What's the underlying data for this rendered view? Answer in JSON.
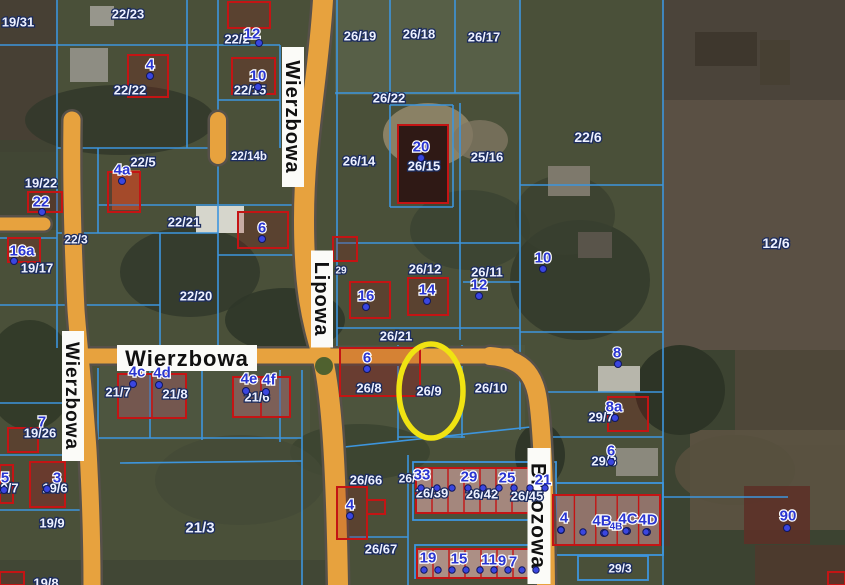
{
  "map": {
    "tool": "cadastral-map-view",
    "highlight": {
      "parcel": "26/9",
      "shape": "ellipse",
      "color": "#F0E312",
      "cx": 431,
      "cy": 391,
      "rx": 32,
      "ry": 47
    },
    "colors": {
      "parcel_line": "#3D95DD",
      "building_outline": "#C41414",
      "street_fill": "#E7A23E",
      "street_casing": "#57514A",
      "parcel_text": "#EDF1FF",
      "building_text": "#2A35D0",
      "highlight": "#F0E312"
    },
    "streets": [
      {
        "name": "Wierzbowa",
        "orientation": "vertical",
        "cx": 293,
        "cy": 117,
        "len": 140,
        "w": 22,
        "fs": 20
      },
      {
        "name": "Lipowa",
        "orientation": "vertical",
        "cx": 322,
        "cy": 299,
        "len": 97,
        "w": 22,
        "fs": 20
      },
      {
        "name": "Wierzbowa",
        "orientation": "horizontal",
        "cx": 187,
        "cy": 358,
        "len": 140,
        "w": 26,
        "fs": 22
      },
      {
        "name": "Wierzbowa",
        "orientation": "vertical",
        "cx": 73,
        "cy": 396,
        "len": 130,
        "w": 22,
        "fs": 19
      },
      {
        "name": "Brzozowa",
        "orientation": "vertical",
        "cx": 539,
        "cy": 516,
        "len": 136,
        "w": 23,
        "fs": 21
      }
    ],
    "parcels": [
      {
        "label": "19/31",
        "x": 18,
        "y": 22
      },
      {
        "label": "22/23",
        "x": 128,
        "y": 14
      },
      {
        "label": "22/2",
        "x": 237,
        "y": 39
      },
      {
        "label": "22/15",
        "x": 250,
        "y": 90
      },
      {
        "label": "22/22",
        "x": 130,
        "y": 90
      },
      {
        "label": "26/19",
        "x": 360,
        "y": 36
      },
      {
        "label": "26/18",
        "x": 419,
        "y": 34
      },
      {
        "label": "26/17",
        "x": 484,
        "y": 37
      },
      {
        "label": "26/22",
        "x": 389,
        "y": 98
      },
      {
        "label": "22/6",
        "x": 588,
        "y": 137,
        "fs": 14
      },
      {
        "label": "12/6",
        "x": 776,
        "y": 243,
        "fs": 14
      },
      {
        "label": "19/22",
        "x": 41,
        "y": 183
      },
      {
        "label": "22/5",
        "x": 143,
        "y": 162
      },
      {
        "label": "22/21",
        "x": 184,
        "y": 222
      },
      {
        "label": "22/20",
        "x": 196,
        "y": 296
      },
      {
        "label": "22/14b",
        "x": 249,
        "y": 156,
        "fs": 11.5
      },
      {
        "label": "19/17",
        "x": 37,
        "y": 268
      },
      {
        "label": "22/3",
        "x": 76,
        "y": 239,
        "fs": 12
      },
      {
        "label": "26/14",
        "x": 359,
        "y": 161
      },
      {
        "label": "26/15",
        "x": 424,
        "y": 166
      },
      {
        "label": "25/16",
        "x": 487,
        "y": 157
      },
      {
        "label": "26/12",
        "x": 425,
        "y": 269
      },
      {
        "label": "26/11",
        "x": 487,
        "y": 272
      },
      {
        "label": "26/21",
        "x": 396,
        "y": 336
      },
      {
        "label": "29",
        "x": 341,
        "y": 270,
        "fs": 10
      },
      {
        "label": "26/8",
        "x": 369,
        "y": 388
      },
      {
        "label": "26/9",
        "x": 429,
        "y": 391
      },
      {
        "label": "26/10",
        "x": 491,
        "y": 388
      },
      {
        "label": "21/7",
        "x": 118,
        "y": 392
      },
      {
        "label": "21/8",
        "x": 175,
        "y": 394
      },
      {
        "label": "21/6",
        "x": 257,
        "y": 397
      },
      {
        "label": "19/26",
        "x": 40,
        "y": 433
      },
      {
        "label": "19/7",
        "x": 6,
        "y": 488
      },
      {
        "label": "19/6",
        "x": 55,
        "y": 488
      },
      {
        "label": "19/9",
        "x": 52,
        "y": 523
      },
      {
        "label": "19/8",
        "x": 46,
        "y": 583
      },
      {
        "label": "21/3",
        "x": 200,
        "y": 527,
        "fs": 15
      },
      {
        "label": "26/66",
        "x": 366,
        "y": 480
      },
      {
        "label": "26/",
        "x": 407,
        "y": 478,
        "fs": 12
      },
      {
        "label": "26/39",
        "x": 432,
        "y": 493
      },
      {
        "label": "26/42",
        "x": 482,
        "y": 494
      },
      {
        "label": "26/45",
        "x": 527,
        "y": 496
      },
      {
        "label": "26/67",
        "x": 381,
        "y": 549
      },
      {
        "label": "29/7",
        "x": 601,
        "y": 417
      },
      {
        "label": "29/3",
        "x": 604,
        "y": 461
      },
      {
        "label": "29/3",
        "x": 620,
        "y": 568,
        "fs": 12
      }
    ],
    "buildings": [
      {
        "label": "4",
        "x": 150,
        "y": 64,
        "dot": [
          150,
          76
        ]
      },
      {
        "label": "12",
        "x": 252,
        "y": 33,
        "dot": [
          259,
          43
        ]
      },
      {
        "label": "10",
        "x": 258,
        "y": 75,
        "dot": [
          258,
          87
        ]
      },
      {
        "label": "22",
        "x": 41,
        "y": 201,
        "dot": [
          42,
          212
        ]
      },
      {
        "label": "16a",
        "x": 22,
        "y": 250,
        "dot": [
          14,
          261
        ]
      },
      {
        "label": "4a",
        "x": 122,
        "y": 169,
        "dot": [
          122,
          181
        ]
      },
      {
        "label": "6",
        "x": 262,
        "y": 227,
        "dot": [
          262,
          239
        ]
      },
      {
        "label": "16",
        "x": 366,
        "y": 295,
        "dot": [
          366,
          307
        ]
      },
      {
        "label": "14",
        "x": 427,
        "y": 289,
        "dot": [
          427,
          301
        ]
      },
      {
        "label": "20",
        "x": 421,
        "y": 146,
        "dot": [
          421,
          158
        ]
      },
      {
        "label": "10",
        "x": 543,
        "y": 257,
        "dot": [
          543,
          269
        ]
      },
      {
        "label": "12",
        "x": 479,
        "y": 284,
        "dot": [
          479,
          296
        ]
      },
      {
        "label": "8",
        "x": 617,
        "y": 352,
        "dot": [
          618,
          364
        ]
      },
      {
        "label": "6",
        "x": 367,
        "y": 357,
        "dot": [
          367,
          369
        ]
      },
      {
        "label": "4c",
        "x": 137,
        "y": 371,
        "dot": [
          133,
          384
        ]
      },
      {
        "label": "4d",
        "x": 162,
        "y": 372,
        "dot": [
          159,
          385
        ]
      },
      {
        "label": "4e",
        "x": 249,
        "y": 378,
        "dot": [
          246,
          391
        ]
      },
      {
        "label": "4f",
        "x": 269,
        "y": 379,
        "dot": [
          266,
          392
        ]
      },
      {
        "label": "7",
        "x": 42,
        "y": 421
      },
      {
        "label": "3",
        "x": 57,
        "y": 477,
        "dot": [
          47,
          489
        ]
      },
      {
        "label": "5",
        "x": 5,
        "y": 477,
        "dot": [
          4,
          490
        ]
      },
      {
        "label": "8a",
        "x": 614,
        "y": 406,
        "dot": [
          615,
          418
        ]
      },
      {
        "label": "6",
        "x": 611,
        "y": 450,
        "dot": [
          611,
          462
        ]
      },
      {
        "label": "4",
        "x": 350,
        "y": 504,
        "dot": [
          350,
          516
        ]
      },
      {
        "label": "33",
        "x": 422,
        "y": 474
      },
      {
        "label": "29",
        "x": 469,
        "y": 476
      },
      {
        "label": "25",
        "x": 507,
        "y": 477
      },
      {
        "label": "21",
        "x": 543,
        "y": 479
      },
      {
        "label": "19",
        "x": 428,
        "y": 557
      },
      {
        "label": "15",
        "x": 459,
        "y": 558
      },
      {
        "label": "11",
        "x": 489,
        "y": 559
      },
      {
        "label": "9",
        "x": 502,
        "y": 560
      },
      {
        "label": "7",
        "x": 513,
        "y": 561
      },
      {
        "label": "4",
        "x": 564,
        "y": 517,
        "dot": [
          561,
          530
        ]
      },
      {
        "label": "4B",
        "x": 602,
        "y": 520,
        "dot": [
          604,
          533
        ]
      },
      {
        "label": "4B",
        "x": 616,
        "y": 526,
        "fs": 10
      },
      {
        "label": "4C",
        "x": 628,
        "y": 518,
        "dot": [
          627,
          531
        ]
      },
      {
        "label": "4D",
        "x": 648,
        "y": 519,
        "dot": [
          647,
          532
        ]
      },
      {
        "label": "90",
        "x": 788,
        "y": 515,
        "dot": [
          787,
          528
        ]
      }
    ],
    "unit_dots": [
      [
        421,
        488
      ],
      [
        437,
        488
      ],
      [
        452,
        488
      ],
      [
        468,
        488
      ],
      [
        483,
        488
      ],
      [
        499,
        488
      ],
      [
        514,
        488
      ],
      [
        530,
        488
      ],
      [
        545,
        488
      ],
      [
        424,
        570
      ],
      [
        438,
        570
      ],
      [
        452,
        570
      ],
      [
        466,
        570
      ],
      [
        480,
        570
      ],
      [
        494,
        570
      ],
      [
        508,
        570
      ],
      [
        522,
        570
      ],
      [
        536,
        570
      ],
      [
        561,
        530
      ],
      [
        583,
        532
      ],
      [
        605,
        533
      ],
      [
        626,
        531
      ],
      [
        646,
        532
      ]
    ]
  }
}
